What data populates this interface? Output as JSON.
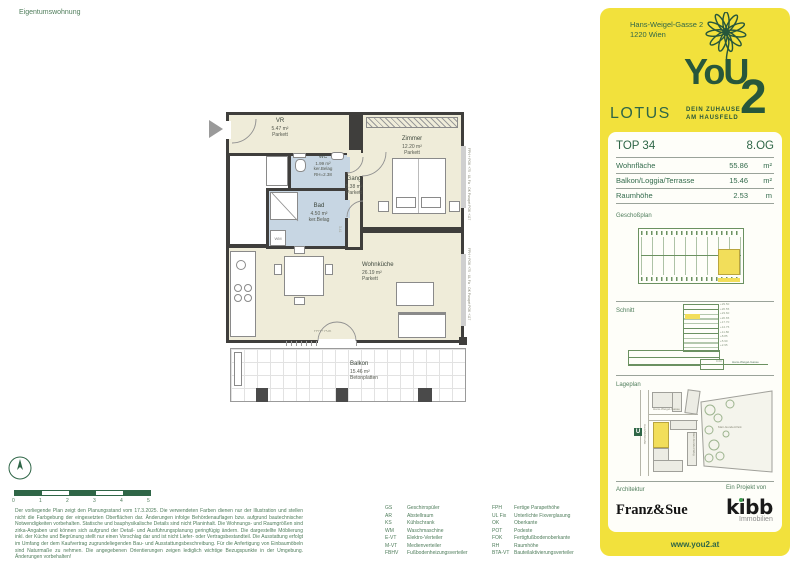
{
  "page": {
    "title": "Eigentumswohnung"
  },
  "plan": {
    "rooms": {
      "vr": {
        "name": "VR",
        "area": "5.47 m²",
        "floor": "Parkett"
      },
      "wc": {
        "name": "WC",
        "area": "1.99 m²",
        "floor": "ker.Belag",
        "rh": "RH=2.38"
      },
      "bad": {
        "name": "Bad",
        "area": "4.50 m²",
        "floor": "ker.Belag"
      },
      "gang": {
        "name": "Gang",
        "area": "5.38 m²",
        "floor": "Parkett"
      },
      "zimmer": {
        "name": "Zimmer",
        "area": "12.20 m²",
        "floor": "Parkett"
      },
      "wohnkueche": {
        "name": "Wohnküche",
        "area": "26.19 m²",
        "floor": "Parkett"
      },
      "balkon": {
        "name": "Balkon",
        "area": "15.46 m²",
        "floor": "Betonplatten"
      }
    },
    "furniture": {
      "wm": "WM"
    },
    "annotations": {
      "door": "FPH + POK",
      "window_zimmer": "FPH + POK +75 · UL Fix · OK Parapet POK +117",
      "window_wohnkueche": "FPH + POK +75 · UL Fix · OK Parapet POK +117",
      "dim": "3.41"
    },
    "scale_labels": [
      "0",
      "1",
      "2",
      "3",
      "4",
      "5"
    ]
  },
  "sidebar": {
    "address_line1": "Hans-Weigel-Gasse 2",
    "address_line2": "1220 Wien",
    "logo": {
      "you": "YoU",
      "two": "2",
      "tagline1": "DEIN ZUHAUSE",
      "tagline2": "AM HAUSFELD"
    },
    "project_name": "LOTUS",
    "unit": {
      "number": "TOP 34",
      "floor": "8.OG"
    },
    "facts": [
      {
        "label": "Wohnfläche",
        "value": "55.86",
        "unit": "m²"
      },
      {
        "label": "Balkon/Loggia/Terrasse",
        "value": "15.46",
        "unit": "m²"
      },
      {
        "label": "Raumhöhe",
        "value": "2.53",
        "unit": "m"
      }
    ],
    "section_labels": {
      "geschossplan": "Geschoßplan",
      "schnitt": "Schnitt",
      "lageplan": "Lageplan"
    },
    "schnitt": {
      "street": "Hans-Weigel-Gasse",
      "base": "0.00",
      "levels": [
        "+29.50",
        "+26.55",
        "+23.60",
        "+20.65",
        "+17.70",
        "+14.75",
        "+11.80",
        "+8.85",
        "+5.90",
        "+2.95"
      ]
    },
    "lageplan": {
      "street_left": "Hausfeldstraße",
      "street_top": "Hans-Weigel-Gasse",
      "street_right": "Mari-Gundel-Weg",
      "park": "Mari-Gundel-Park",
      "metro": "U"
    },
    "credits": {
      "architecture_label": "Architektur",
      "architecture_name": "Franz&Sue",
      "project_label": "Ein Projekt von",
      "developer_name": "kibb",
      "developer_sub": "Immobilien"
    },
    "website": "www.you2.at"
  },
  "footer": {
    "disclaimer": "Der vorliegende Plan zeigt den Planungsstand vom 17.3.2025. Die verwendeten Farben dienen nur der Illustration und stellen nicht die Farbgebung der eingesetzten Oberflächen dar. Änderungen infolge Behördenauflagen bzw. aufgrund bautechnischer Notwendigkeiten vorbehalten. Statische und bauphysikalische Details sind nicht Planinhalt. Die Wohnungs- und Raumgrößen sind zirka-Angaben und können sich aufgrund der Detail- und Ausführungsplanung geringfügig ändern. Die dargestellte Möblierung inkl. der Küche und Begrünung stellt nur einen Vorschlag dar und ist nicht Liefer- oder Vertragsbestandteil. Die Ausstattung erfolgt im Umfang der dem Kaufvertrag zugrundeliegenden Bau- und Ausstattungsbeschreibung. Für die Anfertigung von Einbaumöbeln sind Naturmaße zu nehmen. Die angegebenen Orientierungen zeigen lediglich wichtige Bezugspunkte in der Umgebung. Änderungen vorbehalten!",
    "legend_left": [
      {
        "abbr": "GS",
        "term": "Geschirrspüler"
      },
      {
        "abbr": "AR",
        "term": "Abstellraum"
      },
      {
        "abbr": "KS",
        "term": "Kühlschrank"
      },
      {
        "abbr": "WM",
        "term": "Waschmaschine"
      },
      {
        "abbr": "E-VT",
        "term": "Elektro-Verteiler"
      },
      {
        "abbr": "M-VT",
        "term": "Medienverteiler"
      },
      {
        "abbr": "FBHV",
        "term": "Fußbodenheizungsverteiler"
      }
    ],
    "legend_right": [
      {
        "abbr": "FPH",
        "term": "Fertige Parapethöhe"
      },
      {
        "abbr": "UL Fix",
        "term": "Unterlichte Fixverglasung"
      },
      {
        "abbr": "OK",
        "term": "Oberkante"
      },
      {
        "abbr": "POT",
        "term": "Podeste"
      },
      {
        "abbr": "FOK",
        "term": "Fertigfußbodenoberkante"
      },
      {
        "abbr": "RH",
        "term": "Raumhöhe"
      },
      {
        "abbr": "BTA-VT",
        "term": "Bauteilaktivierungsverteiler"
      }
    ]
  },
  "colors": {
    "brand_yellow": "#F2E13C",
    "brand_green": "#27573B",
    "text_green": "#336B4C",
    "plan_cream": "#EFECD9",
    "plan_blue": "#C7D6E3",
    "wall": "#3F3E3C",
    "highlight_yellow": "#F2DE5A"
  }
}
